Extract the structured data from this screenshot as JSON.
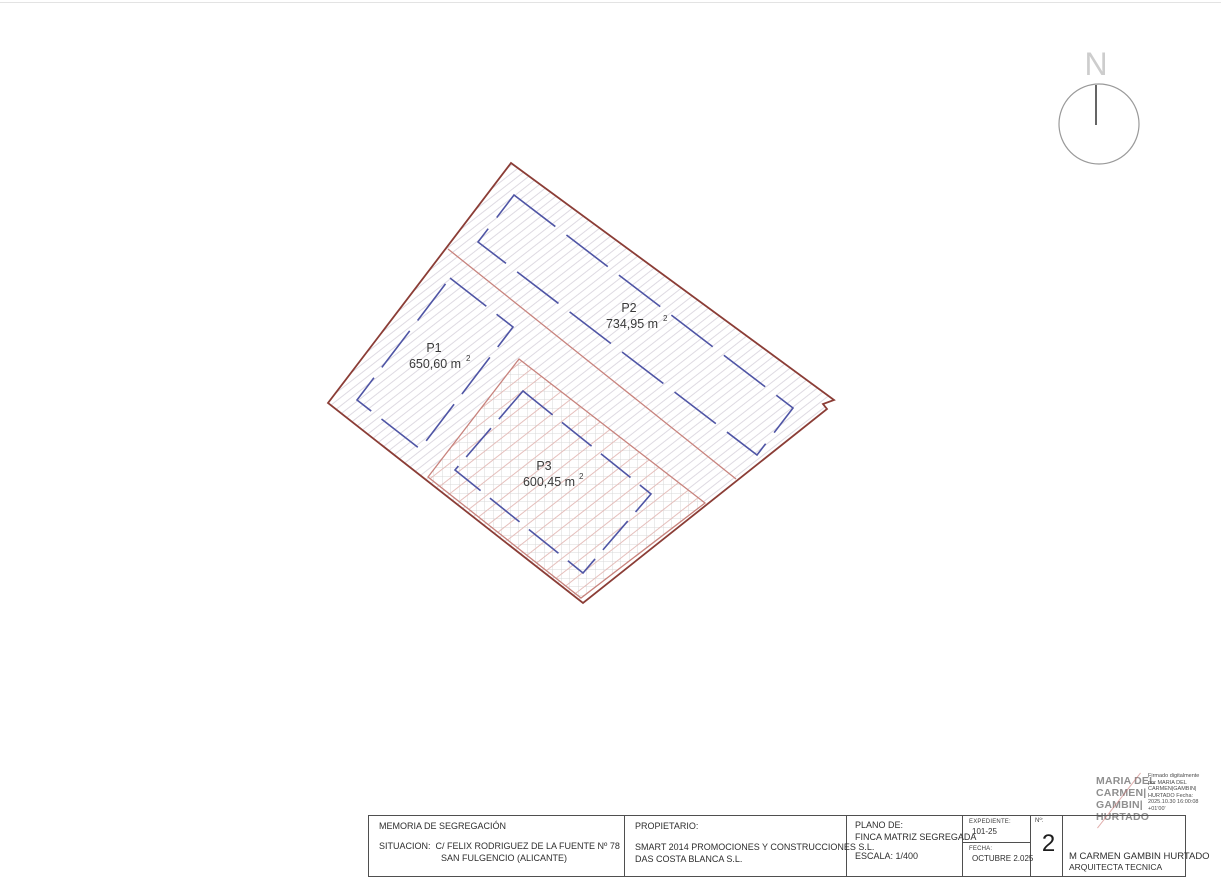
{
  "plan": {
    "north_label": "N",
    "parcels": [
      {
        "id": "P1",
        "area": "650,60 m",
        "area_sup": "2"
      },
      {
        "id": "P2",
        "area": "734,95 m",
        "area_sup": "2"
      },
      {
        "id": "P3",
        "area": "600,45 m",
        "area_sup": "2"
      }
    ],
    "colors": {
      "outer_boundary": "#8b3d36",
      "subdivision_line": "#c8837d",
      "parcel_outline_blue": "#4f55a5",
      "hatch_gray": "#dedae2",
      "hatch_pink": "#e5bfbc",
      "grid_gray": "#d9d9d9",
      "north_gray": "#cdcdcd"
    }
  },
  "titleblock": {
    "memoria": "MEMORIA DE SEGREGACIÓN",
    "situacion_label": "SITUACION:",
    "situacion_value": "C/ FELIX RODRIGUEZ DE LA FUENTE Nº 78",
    "situacion_line2": "SAN FULGENCIO (ALICANTE)",
    "propietario_label": "PROPIETARIO:",
    "propietario_line1": "SMART 2014 PROMOCIONES Y CONSTRUCCIONES S.L.",
    "propietario_line2": "DAS COSTA BLANCA S.L.",
    "plano_label": "PLANO DE:",
    "plano_value": "FINCA MATRIZ SEGREGADA",
    "escala": "ESCALA: 1/400",
    "expediente_label": "EXPEDIENTE:",
    "expediente_value": "101-25",
    "fecha_label": "FECHA:",
    "fecha_value": "OCTUBRE 2.025",
    "numero_label": "Nº:",
    "numero_value": "2",
    "author_name": "M CARMEN GAMBIN HURTADO",
    "author_role": "ARQUITECTA TECNICA"
  },
  "signature": {
    "name_lines": [
      "MARIA DEL",
      "CARMEN|",
      "GAMBIN|",
      "HURTADO"
    ],
    "details": "Firmado digitalmente por MARIA DEL CARMEN|GAMBIN| HURTADO Fecha: 2025.10.30 16:00:08 +01'00'"
  }
}
